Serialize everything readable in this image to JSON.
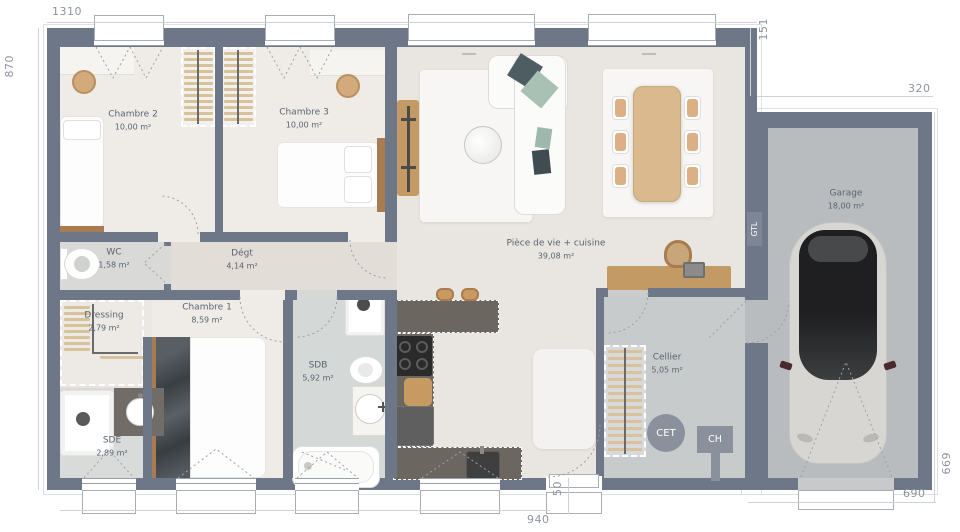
{
  "plan": {
    "dimensions": {
      "width_top": "1310",
      "height_left": "870",
      "offset_right_top": "151",
      "garage_width_top": "320",
      "garage_height_right": "669",
      "garage_width_bottom": "690",
      "door_offset": "50",
      "bottom_width": "940"
    },
    "rooms": {
      "chambre2": {
        "name": "Chambre 2",
        "area": "10,00 m²"
      },
      "chambre3": {
        "name": "Chambre 3",
        "area": "10,00 m²"
      },
      "wc": {
        "name": "WC",
        "area": "1,58 m²"
      },
      "degt": {
        "name": "Dégt",
        "area": "4,14 m²"
      },
      "piece_de_vie": {
        "name": "Pièce de vie + cuisine",
        "area": "39,08 m²"
      },
      "garage": {
        "name": "Garage",
        "area": "18,00 m²"
      },
      "dressing": {
        "name": "Dressing",
        "area": "2,79 m²"
      },
      "chambre1": {
        "name": "Chambre 1",
        "area": "8,59 m²"
      },
      "sdb": {
        "name": "SDB",
        "area": "5,92 m²"
      },
      "sde": {
        "name": "SDE",
        "area": "2,89 m²"
      },
      "cellier": {
        "name": "Cellier",
        "area": "5,05 m²"
      }
    },
    "equipment": {
      "cet": "CET",
      "ch": "CH",
      "gtl": "GTL"
    },
    "colors": {
      "wall": "#6d7787",
      "floor_bedroom": "#efece8",
      "floor_living": "#e9e5e0",
      "floor_hall": "#e2ddd6",
      "floor_wet": "#d5d8d6",
      "floor_cellier": "#c8cbcc",
      "floor_garage": "#b9bcbe",
      "wood": "#c39a63",
      "counter": "#6b665f"
    }
  }
}
